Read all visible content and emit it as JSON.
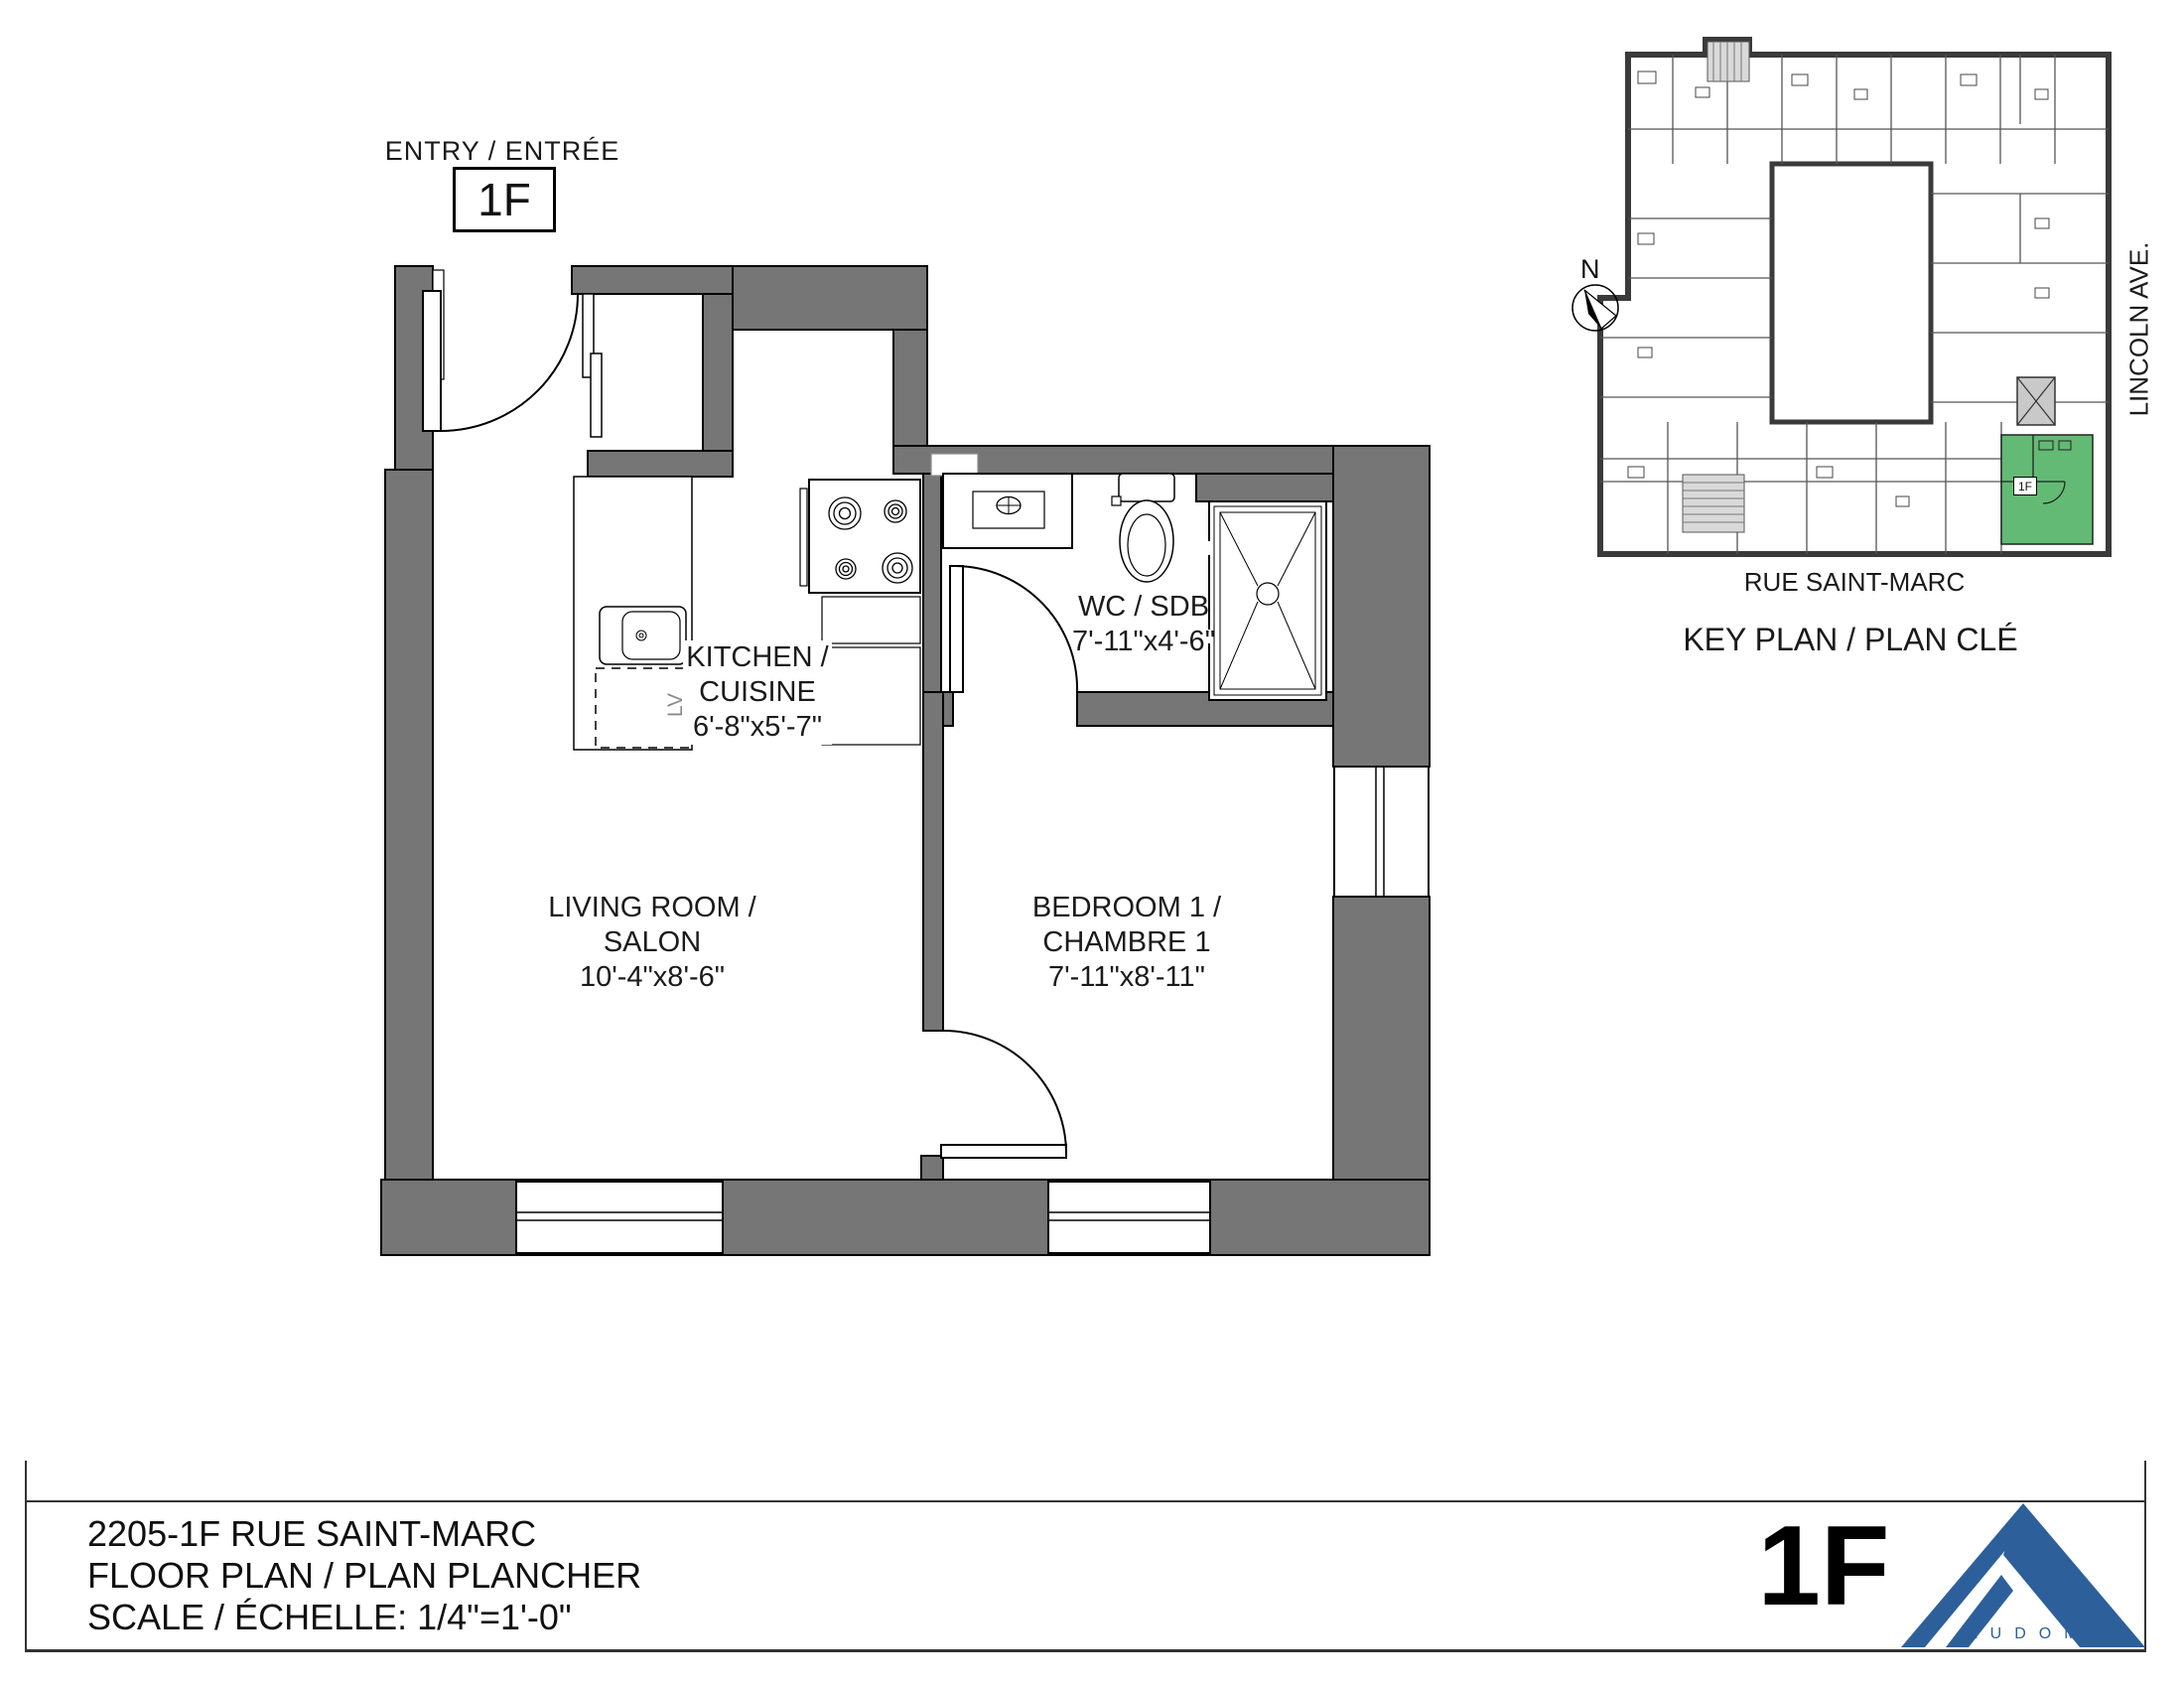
{
  "entry": {
    "label": "ENTRY / ENTRÉE",
    "unit": "1F"
  },
  "rooms": {
    "kitchen": {
      "line1": "KITCHEN /",
      "line2": "CUISINE",
      "dims": "6'-8\"x5'-7\""
    },
    "bathroom": {
      "line1": "WC / SDB",
      "dims": "7'-11\"x4'-6\""
    },
    "living": {
      "line1": "LIVING ROOM /",
      "line2": "SALON",
      "dims": "10'-4\"x8'-6\""
    },
    "bedroom": {
      "line1": "BEDROOM 1 /",
      "line2": "CHAMBRE 1",
      "dims": "7'-11\"x8'-11\""
    }
  },
  "fixtures": {
    "dishwasher": "LV"
  },
  "key_plan": {
    "north": "N",
    "street_right": "LINCOLN AVE.",
    "street_bottom": "RUE SAINT-MARC",
    "caption": "KEY PLAN / PLAN CLÉ",
    "unit_tag": "1F",
    "unit_color": "#63ba74"
  },
  "title_block": {
    "address": "2205-1F RUE SAINT-MARC",
    "drawing_title": "FLOOR PLAN / PLAN PLANCHER",
    "scale_label": "SCALE / ÉCHELLE: 1/4\"=1'-0\"",
    "sheet_unit": "1F",
    "logo": "AUDOM",
    "logo_color": "#2d5f9b"
  },
  "colors": {
    "wall_gray": "#767676",
    "keyplan_dark": "#3a3a3a",
    "highlight_green": "#63ba74",
    "logo_blue": "#2d5f9b"
  }
}
